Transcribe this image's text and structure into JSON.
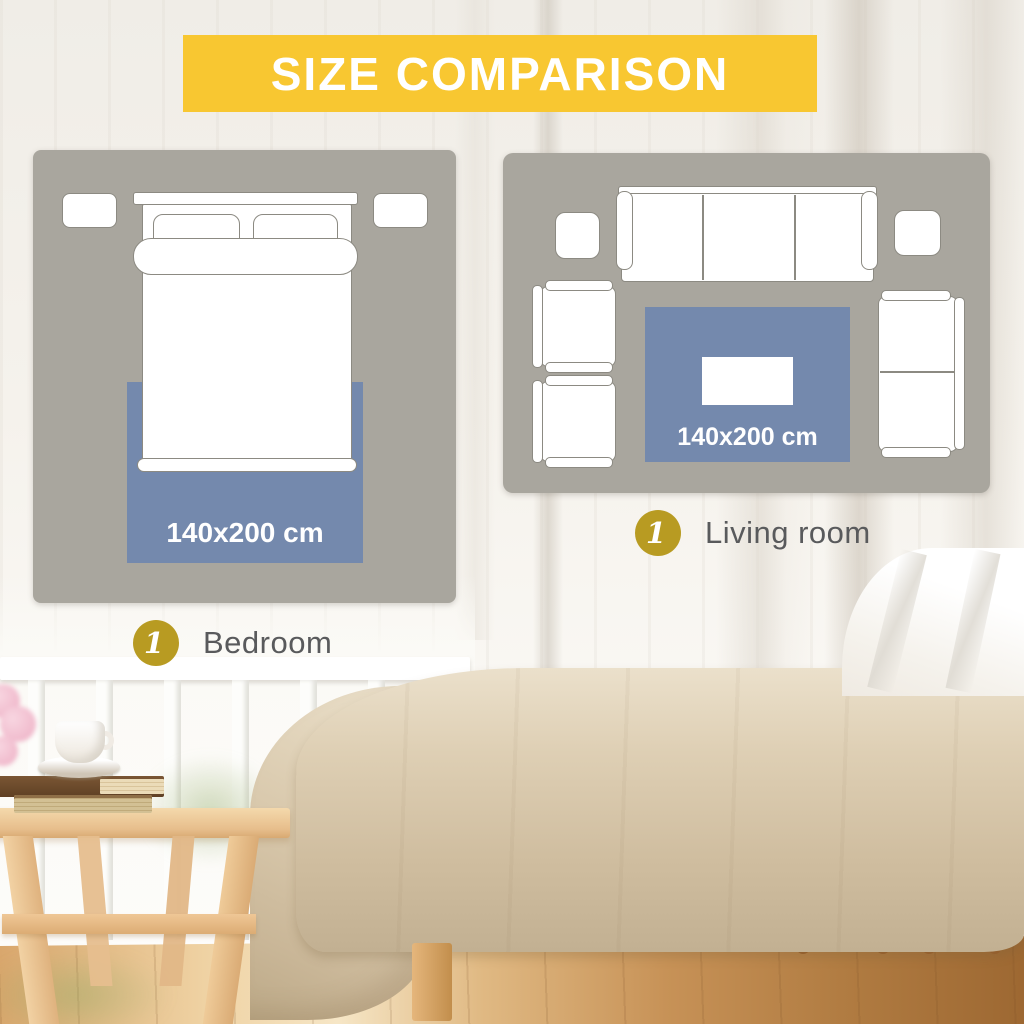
{
  "banner": {
    "title": "SIZE COMPARISON"
  },
  "colors": {
    "banner_yellow": "#F8C731",
    "badge_gold": "#B89B22",
    "rug_blue": "#7489AD",
    "panel_gray": "#A9A69E",
    "furniture_outline": "#8C8A82",
    "room_label_gray": "#595A5C",
    "rug_label_white": "#FFFFFF",
    "banner_text_white": "#FFFFFF"
  },
  "panels": {
    "bedroom": {
      "rug_size": "140x200 cm",
      "badge": "1",
      "room_label": "Bedroom"
    },
    "living_room": {
      "rug_size": "140x200 cm",
      "badge": "1",
      "room_label": "Living room"
    }
  }
}
